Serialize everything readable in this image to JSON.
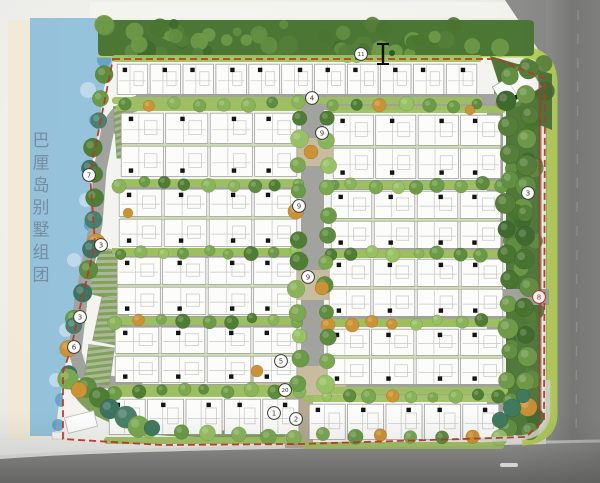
{
  "plan": {
    "title": {
      "text": "巴厘岛别墅组团",
      "chars": [
        "巴",
        "厘",
        "岛",
        "别",
        "墅",
        "组",
        "团"
      ],
      "color": "#74899b",
      "x": 41,
      "y_start": 146,
      "spacing": 22.4,
      "font_size": 17
    },
    "legend_markers": [
      {
        "n": "11",
        "x": 361,
        "y": 54
      },
      {
        "n": "4",
        "x": 312,
        "y": 98
      },
      {
        "n": "9",
        "x": 322,
        "y": 133
      },
      {
        "n": "7",
        "x": 89,
        "y": 175
      },
      {
        "n": "3",
        "x": 528,
        "y": 193
      },
      {
        "n": "9",
        "x": 299,
        "y": 206
      },
      {
        "n": "3",
        "x": 101,
        "y": 245
      },
      {
        "n": "9",
        "x": 308,
        "y": 277
      },
      {
        "n": "8",
        "x": 539,
        "y": 297,
        "accent": true
      },
      {
        "n": "3",
        "x": 80,
        "y": 317
      },
      {
        "n": "6",
        "x": 74,
        "y": 347
      },
      {
        "n": "5",
        "x": 281,
        "y": 361
      },
      {
        "n": "20",
        "x": 285,
        "y": 390
      },
      {
        "n": "1",
        "x": 274,
        "y": 413
      },
      {
        "n": "2",
        "x": 296,
        "y": 419
      }
    ],
    "section_marker": {
      "x": 383,
      "y1": 44,
      "y2": 64,
      "cap": 12
    },
    "colors": {
      "paper": "#efefec",
      "sand": "#efe9d6",
      "water": "#8fc0da",
      "water_dark": "#5f9cc4",
      "water_light": "#c8dfec",
      "forest": "#4b7634",
      "buffer": "#50793a",
      "lawn": "#b9d456",
      "site_base": "#f3f3ef",
      "road": "#a2a29e",
      "road_major": "#828280",
      "road_major_dark": "#717170",
      "plaza": "#c8bc9e",
      "entrance": "#b3a991",
      "strip_green": "#9dc05f",
      "strip_pale": "#cfdfb0",
      "garden_green": "#71974a",
      "house_fill": "#fcfcfa",
      "house_stroke": "#98989a",
      "house_detail": "#c6c6c2",
      "door_black": "#141414",
      "boundary_red": "#c13524",
      "hedge_brown": "#8a4a2a",
      "marker_stroke": "#3c3c3c",
      "marker_accent": "#b03325",
      "curb": "#dcdcd8",
      "palm_teal": "#3f7a5e",
      "tree_palette": [
        "#4e7e33",
        "#5c8c3c",
        "#6a9b46",
        "#79a84f",
        "#88b559",
        "#97c263"
      ],
      "forest_palette": [
        "#3f6a2d",
        "#48752f",
        "#557f38",
        "#628f41",
        "#6f9a48"
      ],
      "shore_palette": [
        "#4e7e33",
        "#5c8c3c",
        "#49806b",
        "#6a9b46",
        "#3c7361",
        "#79a84f"
      ],
      "accent_orange": "#cd9233"
    },
    "blocks": [
      {
        "x": 116,
        "y": 63,
        "w": 362,
        "h": 33,
        "rows": 1,
        "units": 11,
        "dot": "top"
      },
      {
        "x": 120,
        "y": 112,
        "w": 178,
        "h": 66,
        "rows": 2,
        "units": 4
      },
      {
        "x": 332,
        "y": 114,
        "w": 170,
        "h": 66,
        "rows": 2,
        "units": 4
      },
      {
        "x": 118,
        "y": 188,
        "w": 180,
        "h": 60,
        "rows": 2,
        "units": 4
      },
      {
        "x": 330,
        "y": 190,
        "w": 172,
        "h": 60,
        "rows": 2,
        "units": 4
      },
      {
        "x": 116,
        "y": 256,
        "w": 182,
        "h": 60,
        "rows": 2,
        "units": 4
      },
      {
        "x": 328,
        "y": 258,
        "w": 176,
        "h": 60,
        "rows": 2,
        "units": 4
      },
      {
        "x": 114,
        "y": 326,
        "w": 184,
        "h": 58,
        "rows": 2,
        "units": 4
      },
      {
        "x": 326,
        "y": 328,
        "w": 178,
        "h": 58,
        "rows": 2,
        "units": 4
      },
      {
        "x": 108,
        "y": 398,
        "w": 192,
        "h": 38,
        "rows": 1,
        "units": 5,
        "dot": "top"
      },
      {
        "x": 308,
        "y": 403,
        "w": 192,
        "h": 38,
        "rows": 1,
        "units": 5,
        "dot": "top"
      }
    ],
    "angled_unit": {
      "x": 496,
      "y": 74,
      "w": 42,
      "h": 26,
      "rot": -32
    },
    "tree_rows": [
      {
        "x1": 124,
        "y1": 105,
        "x2": 296,
        "y2": 104,
        "n": 8,
        "r": 5,
        "pal": "tree",
        "acc": 0.12
      },
      {
        "x1": 334,
        "y1": 107,
        "x2": 500,
        "y2": 105,
        "n": 8,
        "r": 5,
        "pal": "tree",
        "acc": 0.12
      },
      {
        "x1": 120,
        "y1": 184,
        "x2": 298,
        "y2": 184,
        "n": 9,
        "r": 5,
        "pal": "tree",
        "acc": 0.15
      },
      {
        "x1": 332,
        "y1": 186,
        "x2": 502,
        "y2": 185,
        "n": 9,
        "r": 5,
        "pal": "tree",
        "acc": 0.15
      },
      {
        "x1": 118,
        "y1": 252,
        "x2": 298,
        "y2": 252,
        "n": 9,
        "r": 5,
        "pal": "tree",
        "acc": 0.15
      },
      {
        "x1": 330,
        "y1": 254,
        "x2": 504,
        "y2": 253,
        "n": 9,
        "r": 5,
        "pal": "tree",
        "acc": 0.15
      },
      {
        "x1": 116,
        "y1": 321,
        "x2": 298,
        "y2": 320,
        "n": 9,
        "r": 5,
        "pal": "tree",
        "acc": 0.15
      },
      {
        "x1": 328,
        "y1": 323,
        "x2": 504,
        "y2": 322,
        "n": 9,
        "r": 5,
        "pal": "tree",
        "acc": 0.15
      },
      {
        "x1": 114,
        "y1": 392,
        "x2": 298,
        "y2": 391,
        "n": 9,
        "r": 5,
        "pal": "tree",
        "acc": 0.1
      },
      {
        "x1": 326,
        "y1": 397,
        "x2": 500,
        "y2": 396,
        "n": 9,
        "r": 5,
        "pal": "tree",
        "acc": 0.1
      },
      {
        "x1": 298,
        "y1": 116,
        "x2": 298,
        "y2": 384,
        "n": 12,
        "r": 7,
        "pal": "tree",
        "acc": 0.08
      },
      {
        "x1": 327,
        "y1": 116,
        "x2": 327,
        "y2": 384,
        "n": 12,
        "r": 7,
        "pal": "tree",
        "acc": 0.08
      },
      {
        "x1": 508,
        "y1": 78,
        "x2": 508,
        "y2": 428,
        "n": 15,
        "r": 8,
        "pal": "forest",
        "acc": 0.05
      },
      {
        "x1": 527,
        "y1": 68,
        "x2": 527,
        "y2": 430,
        "n": 16,
        "r": 8,
        "pal": "forest",
        "acc": 0.05
      },
      {
        "x1": 150,
        "y1": 433,
        "x2": 500,
        "y2": 438,
        "n": 13,
        "r": 6,
        "pal": "tree",
        "acc": 0.08
      },
      {
        "x1": 104,
        "y1": 74,
        "x2": 92,
        "y2": 170,
        "n": 5,
        "r": 8,
        "pal": "shore",
        "acc": 0.1
      },
      {
        "x1": 92,
        "y1": 176,
        "x2": 95,
        "y2": 242,
        "n": 4,
        "r": 8,
        "pal": "shore",
        "acc": 0.1
      },
      {
        "x1": 93,
        "y1": 248,
        "x2": 76,
        "y2": 318,
        "n": 4,
        "r": 8,
        "pal": "shore",
        "acc": 0.1
      },
      {
        "x1": 74,
        "y1": 325,
        "x2": 66,
        "y2": 372,
        "n": 3,
        "r": 8,
        "pal": "shore",
        "acc": 0.1
      },
      {
        "x1": 70,
        "y1": 380,
        "x2": 140,
        "y2": 428,
        "n": 6,
        "r": 9,
        "pal": "shore",
        "acc": 0.12
      }
    ],
    "accent_trees": [
      {
        "x": 311,
        "y": 152,
        "r": 7
      },
      {
        "x": 322,
        "y": 288,
        "r": 7
      },
      {
        "x": 79,
        "y": 390,
        "r": 8
      },
      {
        "x": 257,
        "y": 371,
        "r": 6
      },
      {
        "x": 128,
        "y": 213,
        "r": 5
      },
      {
        "x": 470,
        "y": 110,
        "r": 5
      }
    ],
    "palm_trees": [
      {
        "x": 512,
        "y": 408,
        "r": 9
      },
      {
        "x": 523,
        "y": 396,
        "r": 7
      },
      {
        "x": 500,
        "y": 420,
        "r": 8
      },
      {
        "x": 152,
        "y": 428,
        "r": 8
      }
    ],
    "parking_bays": [
      {
        "x": 115,
        "y": 106,
        "w": 13,
        "h": 52,
        "rot": -4
      },
      {
        "x": 94,
        "y": 250,
        "w": 32,
        "h": 48,
        "rot": 14
      },
      {
        "x": 97,
        "y": 298,
        "w": 30,
        "h": 46,
        "rot": 12
      },
      {
        "x": 86,
        "y": 346,
        "w": 26,
        "h": 38,
        "rot": 8
      }
    ],
    "beach_structure": {
      "x": 66,
      "y": 414,
      "w": 30,
      "h": 16,
      "rot": -14
    },
    "road_dash": {
      "x": 500,
      "y": 463,
      "w": 18,
      "h": 4
    }
  }
}
